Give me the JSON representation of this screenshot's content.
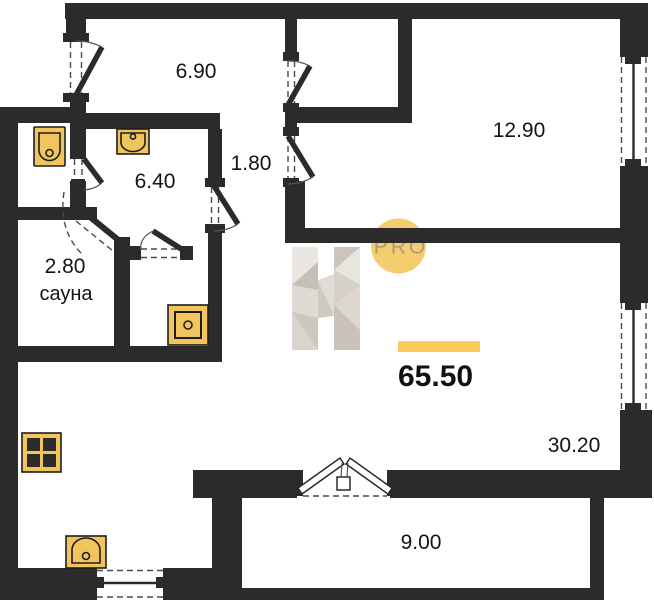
{
  "plan": {
    "total_area": "65.50",
    "rooms": {
      "hallway": {
        "area": "6.90"
      },
      "corridor": {
        "area": "1.80"
      },
      "bedroom": {
        "area": "12.90"
      },
      "bathroom": {
        "area": "6.40"
      },
      "sauna": {
        "area": "2.80",
        "name": "сауна"
      },
      "living_kitchen": {
        "area": "30.20"
      },
      "balcony": {
        "area": "9.00"
      }
    },
    "watermark": {
      "letter": "H",
      "badge": "PRO"
    },
    "fixtures": [
      "toilet",
      "washbasin",
      "shower-tray",
      "stove",
      "kitchen-sink"
    ],
    "colors": {
      "wall": "#2B2B2B",
      "background": "#FFFFFF",
      "fixture_fill": "#F2C45E",
      "accent_bar": "#F9CA5C",
      "watermark_circle": "#F4CE6E",
      "watermark_letter": "#D9D4CC",
      "text": "#141414"
    }
  }
}
